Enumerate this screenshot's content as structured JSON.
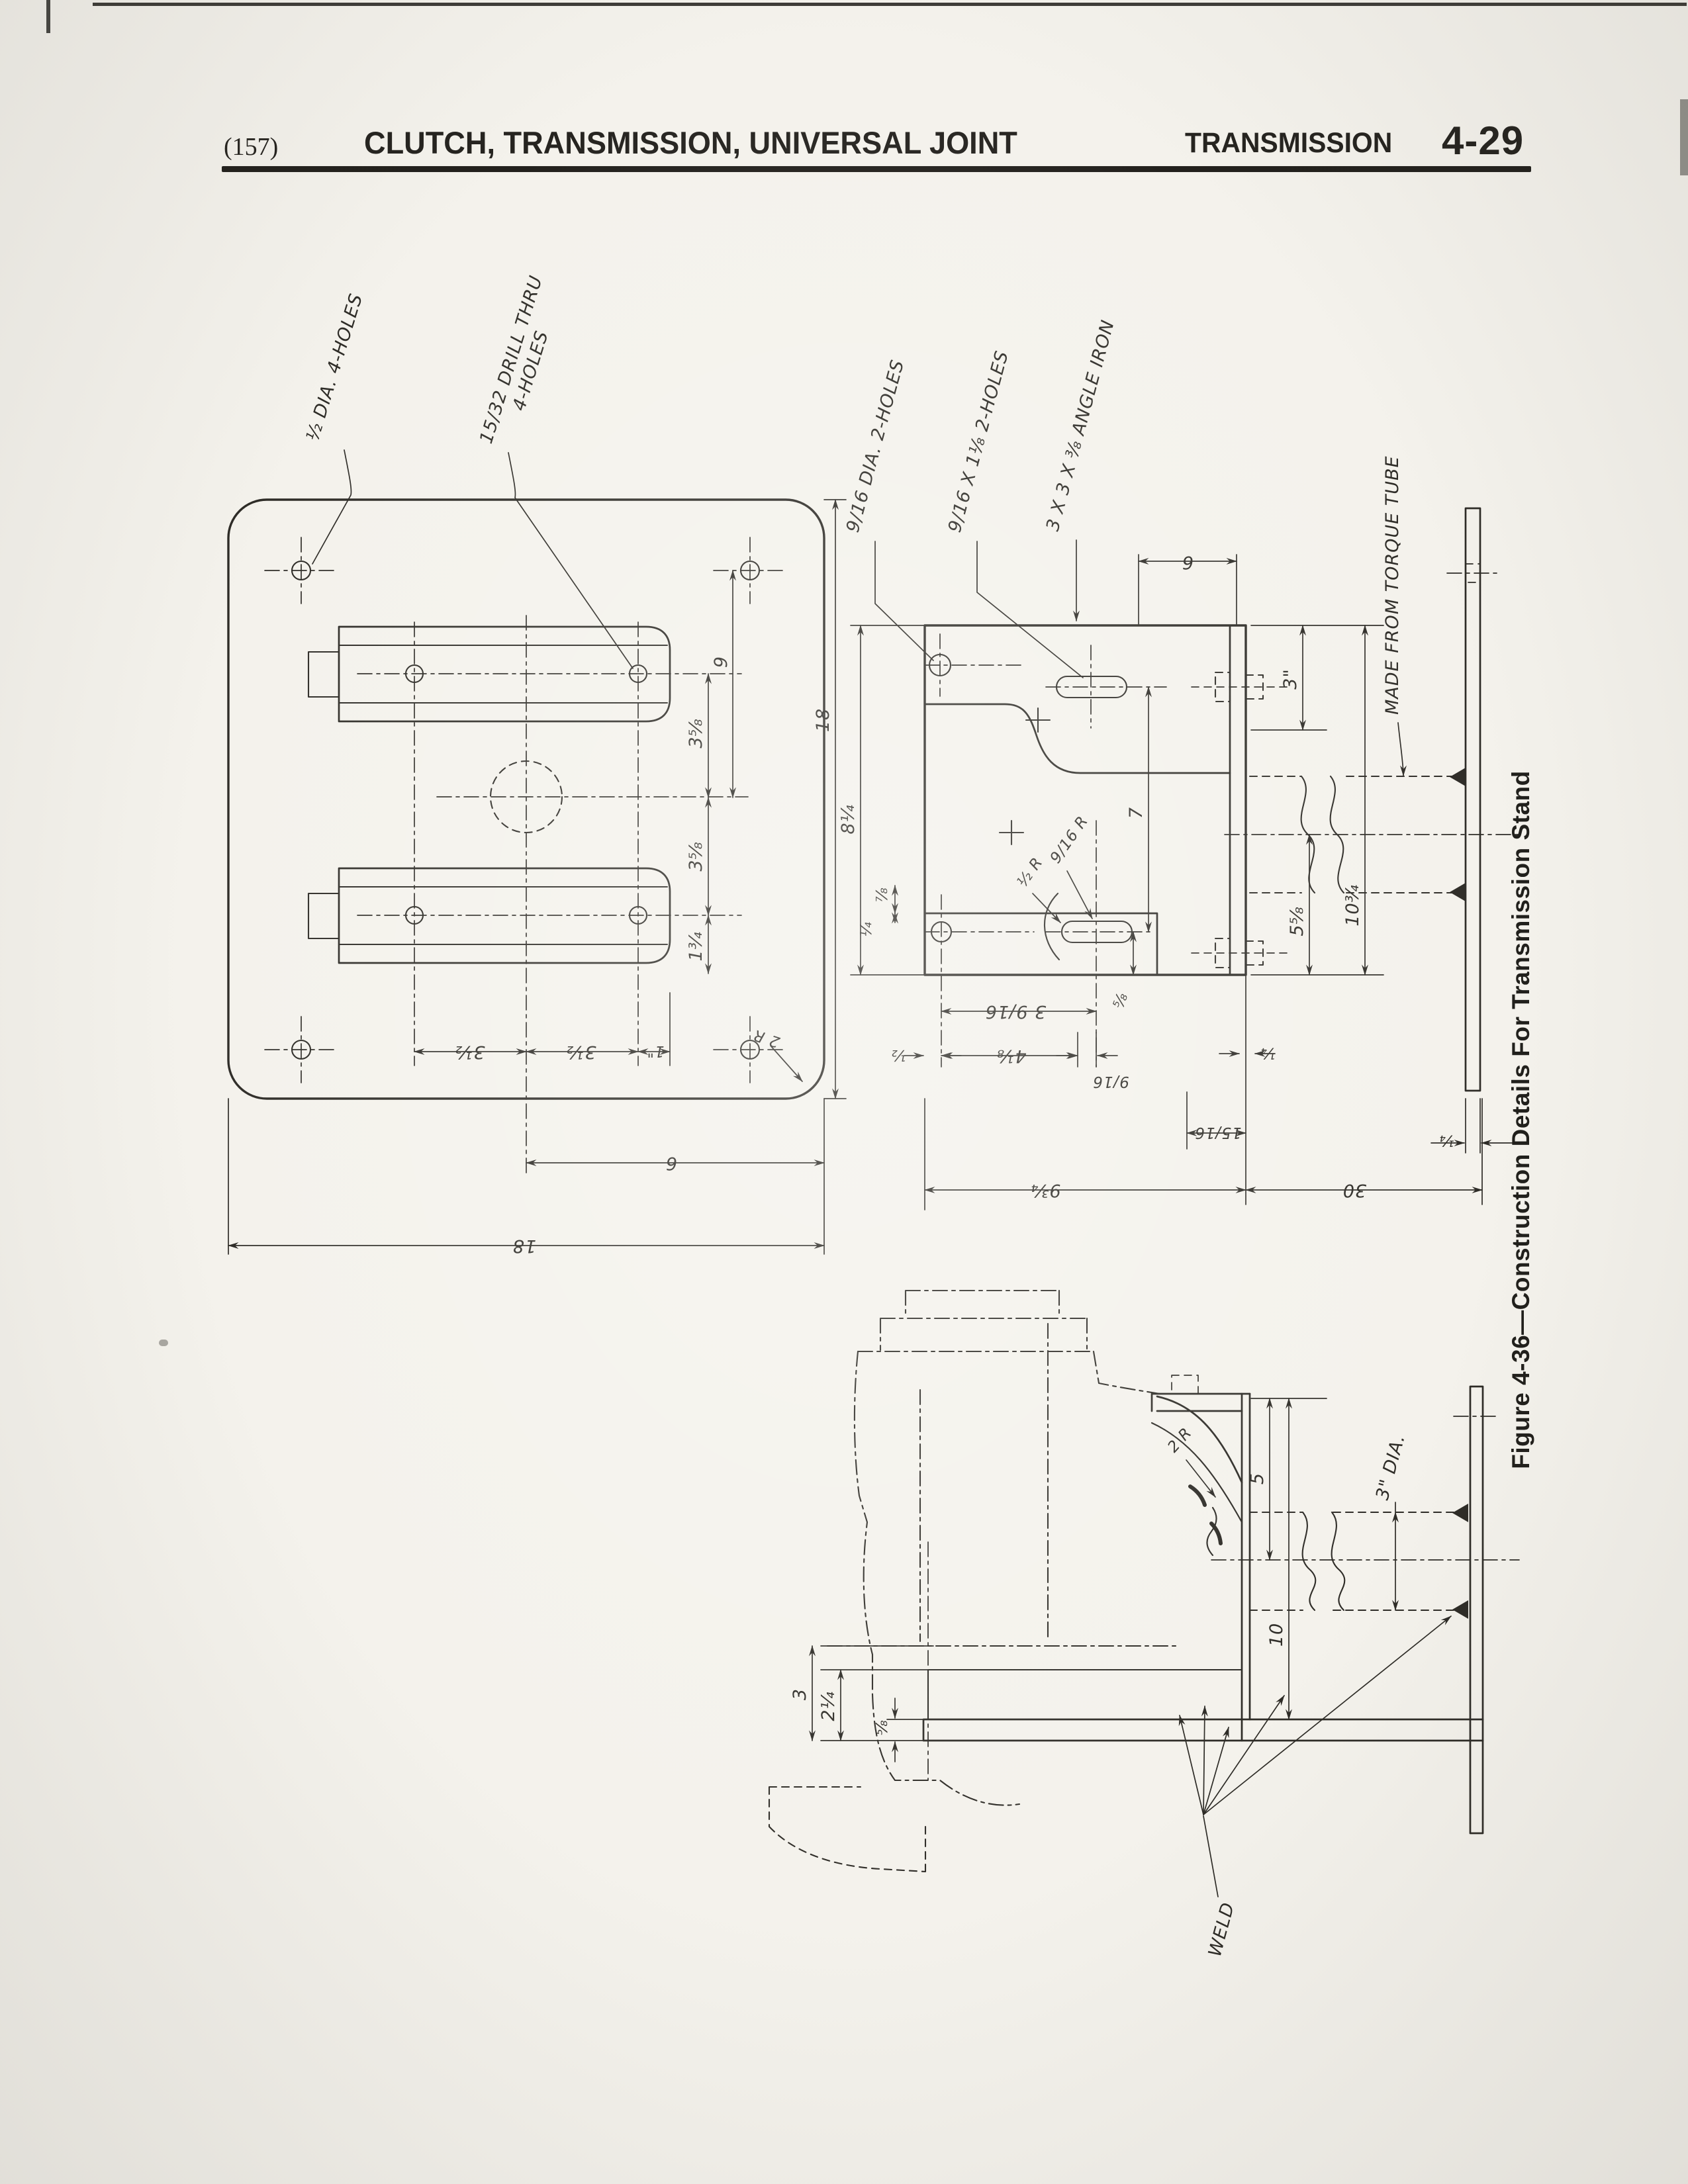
{
  "page": {
    "paper": "#f4f2ec",
    "ink": "#2e2c27"
  },
  "header": {
    "page_ref": "(157)",
    "title": "CLUTCH, TRANSMISSION, UNIVERSAL JOINT",
    "section": "TRANSMISSION",
    "page_number": "4-29"
  },
  "figure_caption": "Figure 4-36—Construction Details For Transmission Stand",
  "plate": {
    "callouts": {
      "half_dia": "½ DIA. 4-HOLES",
      "drill1": "15/32 DRILL THRU",
      "drill2": "4-HOLES",
      "corner_r": "2 R"
    },
    "dims": {
      "v9": "9",
      "v358a": "3⅝",
      "v358b": "3⅝",
      "v134": "1¾",
      "v18": "18",
      "b312a": "3½",
      "b312b": "3½",
      "b1": "1\"",
      "b6": "6",
      "b18": "18"
    }
  },
  "plan": {
    "callouts": {
      "dia2": "9/16 DIA. 2-HOLES",
      "slot2": "9/16 X 1⅛ 2-HOLES",
      "angle": "3 X 3 X ⅜ ANGLE IRON",
      "tube": "MADE FROM TORQUE TUBE",
      "r_half": "½ R",
      "r_916": "9/16 R"
    },
    "dims": {
      "t6": "6",
      "t3": "3\"",
      "v7": "7",
      "v814": "8¼",
      "s14": "¼",
      "s78": "⅞",
      "s58": "⅝",
      "v538": "5⅝",
      "v1034": "10¾",
      "b3916": "3 9/16",
      "b12": "½",
      "b418": "4⅛",
      "b916": "9/16",
      "b1516": "15/16",
      "b14a": "¼",
      "b934": "9¾",
      "b30": "30",
      "b14b": "¼"
    }
  },
  "side": {
    "callouts": {
      "weld": "WELD",
      "dia3": "3\" DIA.",
      "r2": "2 R"
    },
    "dims": {
      "v3": "3",
      "v214": "2¼",
      "v58": "⅝",
      "v5": "5",
      "v10": "10"
    }
  }
}
